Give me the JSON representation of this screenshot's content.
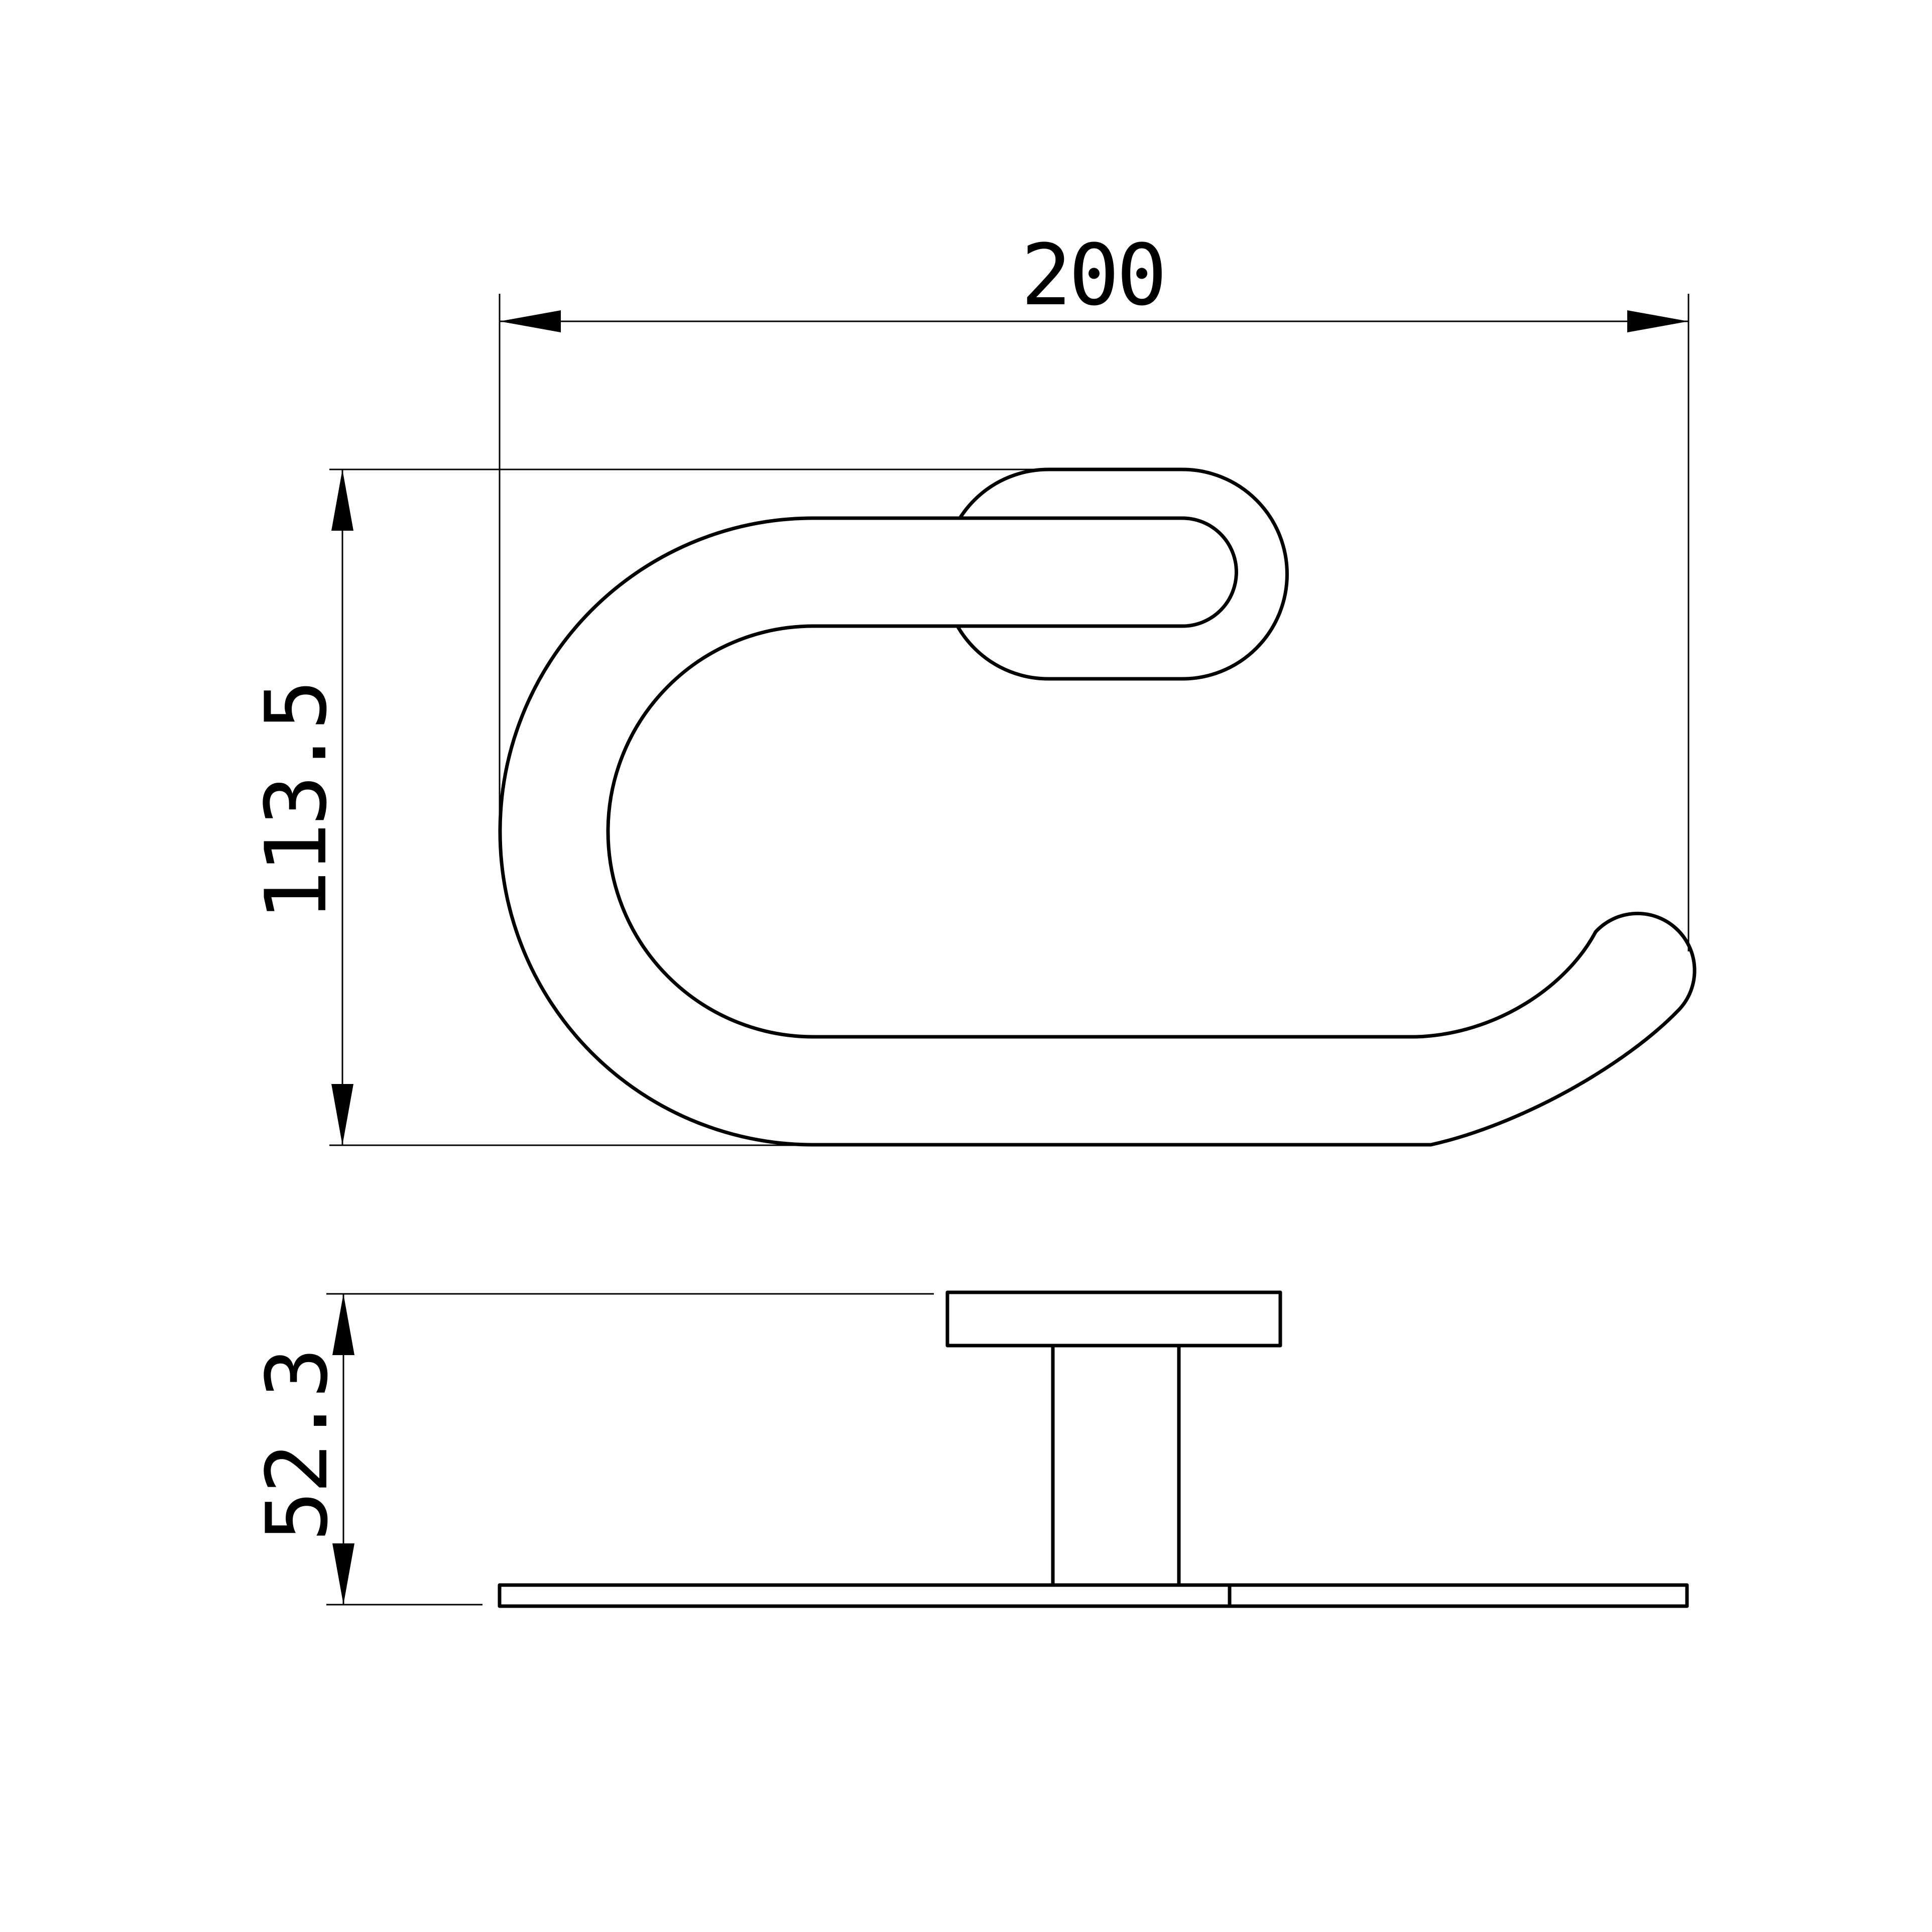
{
  "drawing": {
    "background_color": "#ffffff",
    "line_color": "#000000",
    "dimensions": {
      "overall_width": {
        "value": "200",
        "orientation": "horizontal"
      },
      "overall_height": {
        "value": "113.5",
        "orientation": "vertical"
      },
      "projection_depth": {
        "value": "52.3",
        "orientation": "vertical"
      }
    }
  }
}
